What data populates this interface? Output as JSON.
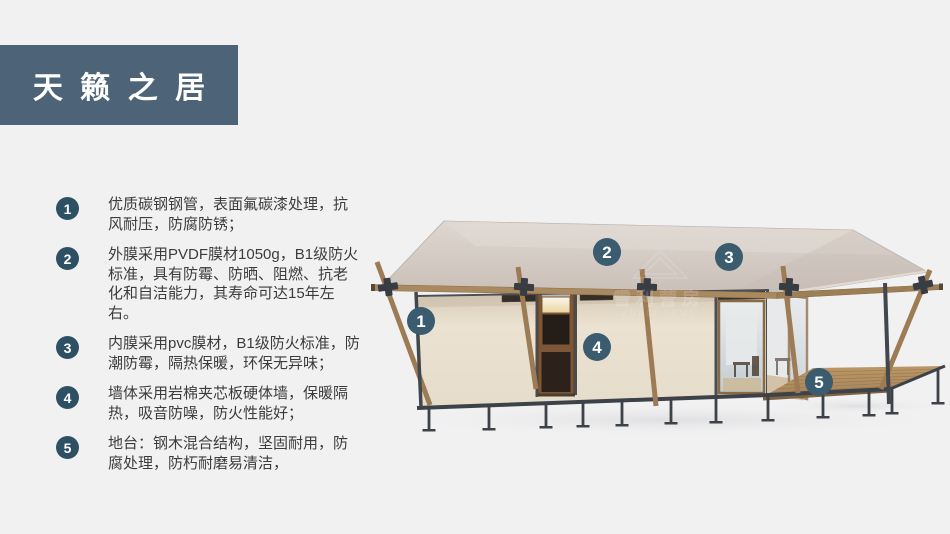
{
  "title": "天籁之居",
  "features": [
    {
      "num": "1",
      "text": "优质碳钢钢管，表面氟碳漆处理，抗风耐压，防腐防锈；"
    },
    {
      "num": "2",
      "text": "外膜采用PVDF膜材1050g，B1级防火标准，具有防霉、防晒、阻燃、抗老化和自洁能力，其寿命可达15年左右。"
    },
    {
      "num": "3",
      "text": "内膜采用pvc膜材，B1级防火标准，防潮防霉，隔热保暖，环保无异味；"
    },
    {
      "num": "4",
      "text": "墙体采用岩棉夹芯板硬体墙，保暖隔热，吸音防噪，防火性能好；"
    },
    {
      "num": "5",
      "text": "地台：钢木混合结构，坚固耐用，防腐处理，防朽耐磨易清洁，"
    }
  ],
  "illustration": {
    "markers": [
      {
        "num": "1"
      },
      {
        "num": "2"
      },
      {
        "num": "3"
      },
      {
        "num": "4"
      },
      {
        "num": "5"
      }
    ],
    "watermark": {
      "cn": "雪利营房",
      "en": "XUELI TENT"
    }
  },
  "colors": {
    "page_background": "#f1f1f2",
    "title_block": "#4d6377",
    "list_badge": "#2e5063",
    "image_marker": "#3a5c6e",
    "roof": "#d0c6be",
    "wall": "#e9e0cf",
    "wood": "#9c7b55",
    "steel": "#42464d",
    "deck": "#b5905f"
  }
}
